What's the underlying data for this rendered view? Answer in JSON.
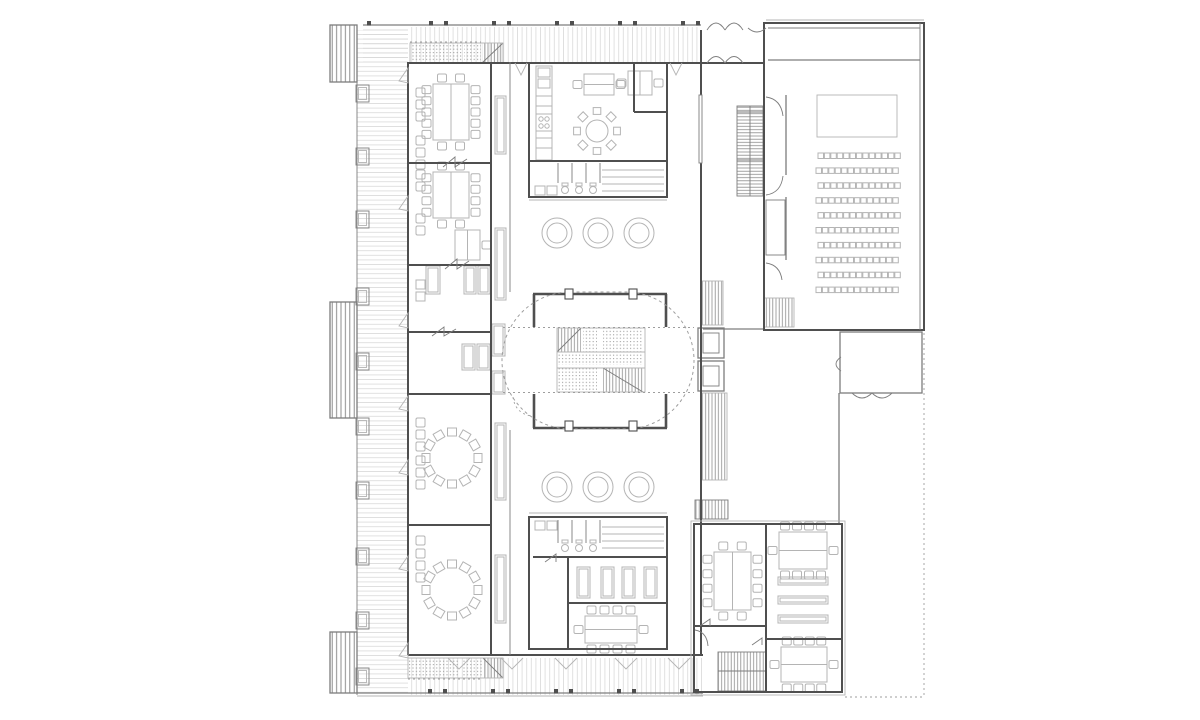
{
  "colors": {
    "background": "#ffffff",
    "wall": "#4f4f4f",
    "wall_medium": "#7d7d7d",
    "furniture": "#b4b4b4",
    "deck_stripe": "#d9d9d9",
    "hatch": "#8c8c8c",
    "dashed": "#9e9e9e"
  },
  "plan": {
    "chair": {
      "w": 9,
      "h": 8
    },
    "balconies": [
      {
        "x": 330,
        "y": 25,
        "w": 27,
        "h": 57
      },
      {
        "x": 330,
        "y": 302,
        "w": 27,
        "h": 116
      },
      {
        "x": 330,
        "y": 632,
        "w": 27,
        "h": 61
      }
    ],
    "facade_boxes": {
      "x": 356,
      "w": 13,
      "h": 17,
      "ys": [
        85,
        148,
        211,
        288,
        353,
        418,
        482,
        548,
        612,
        668
      ]
    },
    "ticks_top": {
      "y": 21,
      "xs": [
        367,
        429,
        444,
        492,
        507,
        555,
        570,
        618,
        633,
        681,
        696
      ]
    },
    "ticks_bottom": {
      "y": 689,
      "xs": [
        428,
        443,
        491,
        506,
        554,
        569,
        617,
        632,
        680,
        695
      ]
    },
    "tables": [
      {
        "x": 433,
        "y": 84,
        "w": 36,
        "h": 56,
        "chairs": {
          "top": 2,
          "bottom": 2,
          "left": 5,
          "right": 5
        }
      },
      {
        "x": 433,
        "y": 172,
        "w": 36,
        "h": 46,
        "chairs": {
          "top": 2,
          "bottom": 2,
          "left": 4,
          "right": 4
        }
      },
      {
        "x": 455,
        "y": 230,
        "w": 25,
        "h": 30,
        "chairs": {
          "top": 0,
          "bottom": 0,
          "left": 0,
          "right": 1
        }
      },
      {
        "x": 584,
        "y": 74,
        "w": 30,
        "h": 21,
        "chairs": {
          "top": 0,
          "bottom": 0,
          "left": 1,
          "right": 1
        }
      },
      {
        "x": 628,
        "y": 71,
        "w": 24,
        "h": 24,
        "chairs": {
          "top": 0,
          "bottom": 0,
          "left": 1,
          "right": 1
        }
      },
      {
        "x": 585,
        "y": 616,
        "w": 52,
        "h": 27,
        "chairs": {
          "top": 4,
          "bottom": 4,
          "left": 1,
          "right": 1
        }
      },
      {
        "x": 714,
        "y": 552,
        "w": 37,
        "h": 58,
        "chairs": {
          "top": 2,
          "bottom": 2,
          "left": 4,
          "right": 4
        }
      },
      {
        "x": 779,
        "y": 532,
        "w": 48,
        "h": 37,
        "chairs": {
          "top": 4,
          "bottom": 4,
          "left": 1,
          "right": 1
        }
      },
      {
        "x": 781,
        "y": 647,
        "w": 46,
        "h": 35,
        "chairs": {
          "top": 4,
          "bottom": 4,
          "left": 1,
          "right": 1
        }
      }
    ],
    "long_tables": [
      [
        778,
        577,
        50,
        8
      ],
      [
        778,
        596,
        50,
        8
      ],
      [
        778,
        615,
        50,
        8
      ]
    ],
    "sofas": [
      [
        426,
        266,
        14,
        28
      ],
      [
        464,
        266,
        12,
        28
      ],
      [
        478,
        266,
        12,
        28
      ],
      [
        462,
        344,
        13,
        26
      ],
      [
        477,
        344,
        13,
        26
      ]
    ],
    "small_boxes": [
      [
        416,
        280,
        9,
        9
      ],
      [
        416,
        292,
        9,
        9
      ]
    ],
    "standing_desks": [
      [
        577,
        567,
        13,
        31
      ],
      [
        601,
        567,
        13,
        31
      ],
      [
        622,
        567,
        13,
        31
      ],
      [
        644,
        567,
        13,
        31
      ]
    ],
    "lockers": [
      [
        495,
        96,
        11,
        58
      ],
      [
        495,
        228,
        11,
        72
      ],
      [
        492,
        324,
        13,
        32
      ],
      [
        492,
        371,
        13,
        23
      ],
      [
        495,
        423,
        11,
        77
      ],
      [
        495,
        555,
        11,
        68
      ]
    ],
    "wall_chairs": {
      "x": 416,
      "size": 9,
      "ys": [
        88,
        100,
        112,
        136,
        148,
        160,
        170,
        182,
        214,
        226,
        418,
        430,
        442,
        456,
        468,
        480,
        536,
        549,
        561,
        573
      ]
    },
    "chair_circles": [
      {
        "cx": 452,
        "cy": 458,
        "r": 26,
        "n": 12
      },
      {
        "cx": 452,
        "cy": 590,
        "r": 26,
        "n": 12
      }
    ],
    "round_tables": [
      {
        "cx": 597,
        "cy": 131,
        "r": 11,
        "chair_r": 20,
        "n": 8
      }
    ],
    "double_circles": {
      "r_out": 15,
      "r_in": 10,
      "rows": [
        {
          "y": 233,
          "xs": [
            557,
            598,
            639
          ]
        },
        {
          "y": 487,
          "xs": [
            557,
            598,
            639
          ]
        }
      ]
    },
    "auditorium": {
      "stage": {
        "x": 817,
        "y": 95,
        "w": 80,
        "h": 42
      },
      "seats": {
        "x0": 818,
        "y0": 153,
        "cols": 13,
        "rows": 10,
        "dx": 6.4,
        "dy": 14.9,
        "w": 5.5,
        "h": 5.5,
        "stagger": 2
      }
    },
    "door_v_south": {
      "y": 658,
      "xs": [
        448,
        501,
        555,
        615,
        668
      ],
      "span": 22,
      "depth": 11
    },
    "door_v_north": {
      "y": 63,
      "xs": [
        515,
        670
      ],
      "span": 12,
      "depth": 12
    },
    "door_flags_west": {
      "x": 408,
      "ys": [
        68,
        196,
        313,
        396,
        460,
        556,
        643
      ]
    }
  }
}
